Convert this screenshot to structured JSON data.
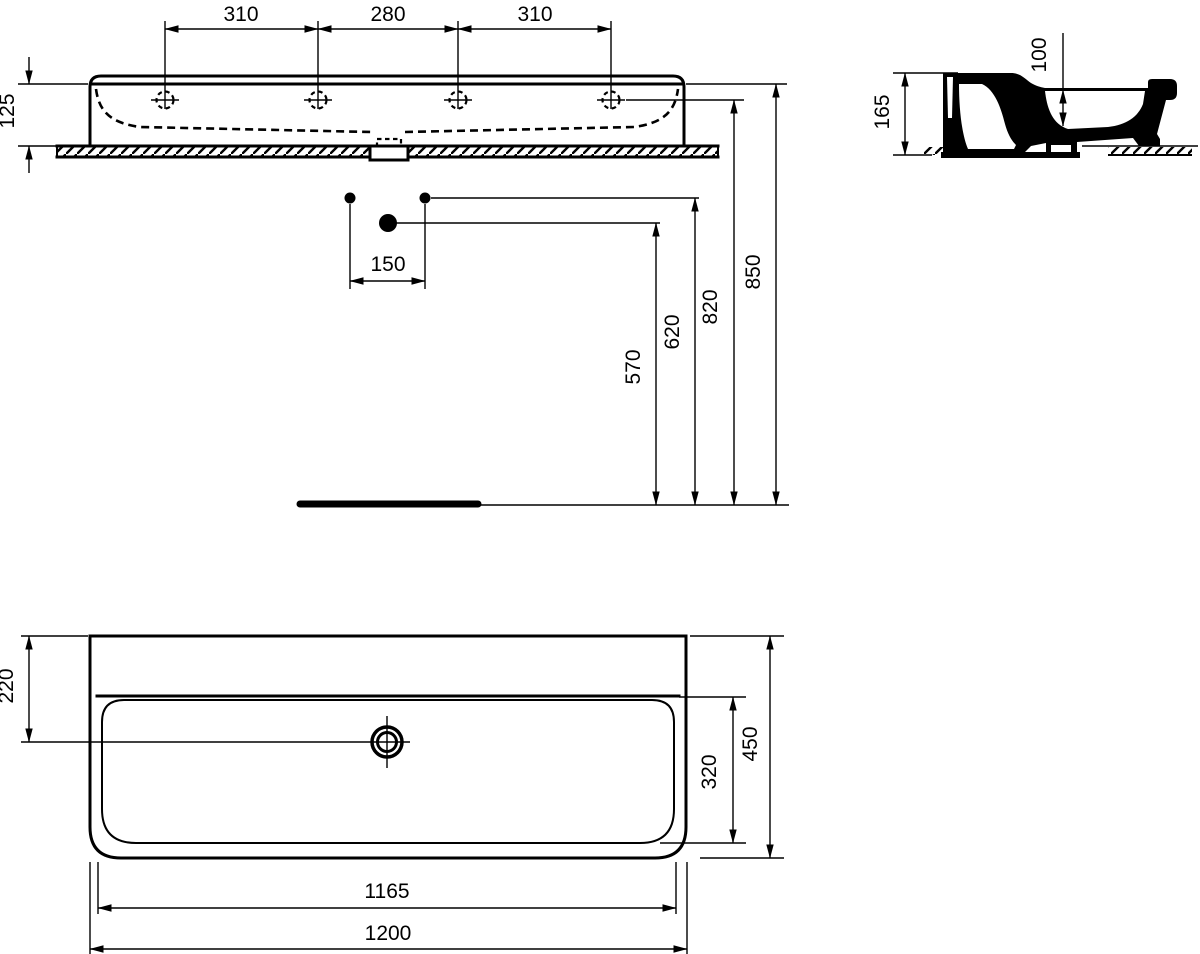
{
  "front_view": {
    "tap_spacing_left": "310",
    "tap_spacing_center": "280",
    "tap_spacing_right": "310",
    "rim_height": "125"
  },
  "side_view": {
    "total_height": "165",
    "bowl_depth": "100"
  },
  "installation": {
    "supply_offset": "150",
    "drain_height": "570",
    "supply_height": "620",
    "tap_hole_height": "820",
    "rim_height_from_floor": "850"
  },
  "plan_view": {
    "front_to_drain": "220",
    "overall_depth": "450",
    "bowl_depth": "320",
    "bowl_width": "1165",
    "overall_width": "1200"
  }
}
